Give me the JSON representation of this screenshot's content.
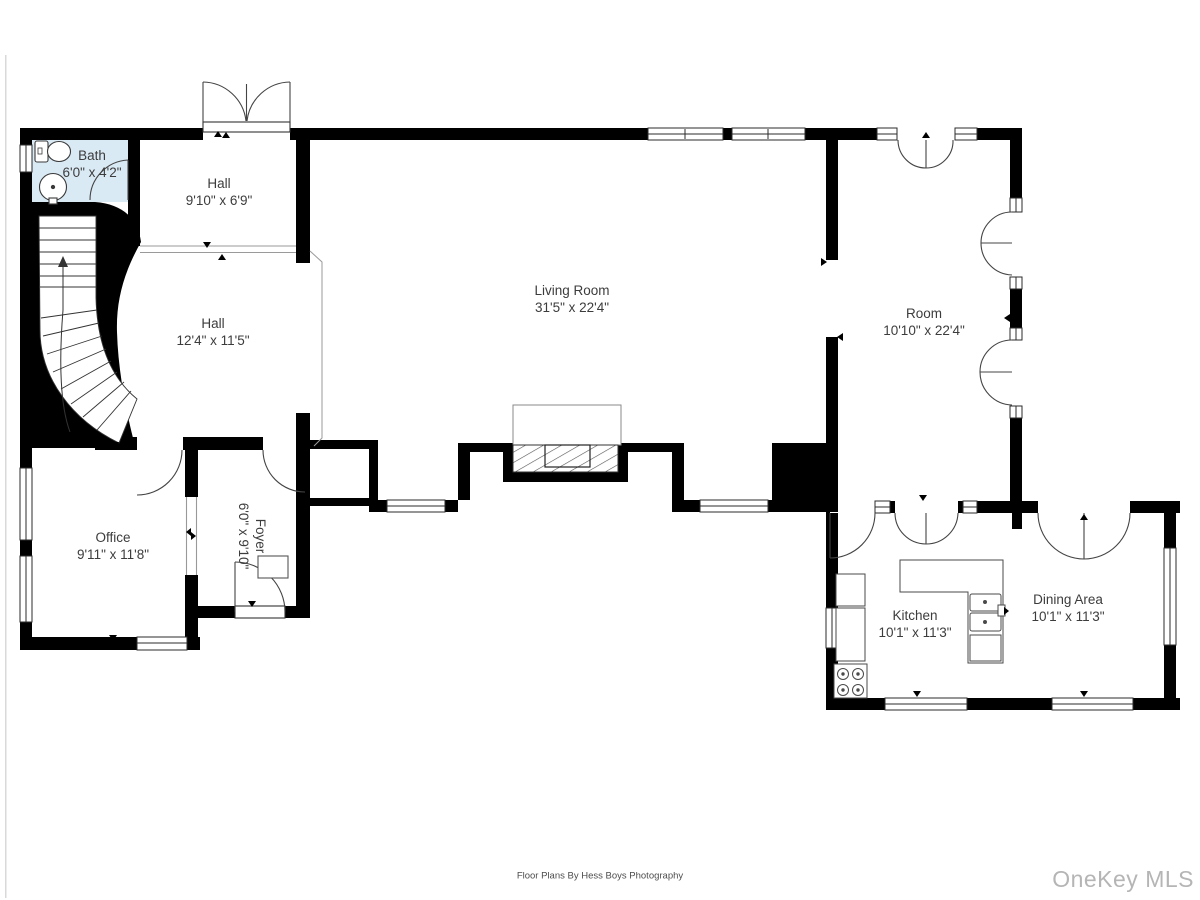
{
  "floor_plan": {
    "rooms": [
      {
        "id": "bath",
        "name": "Bath",
        "dimensions": "6'0\" x 4'2\"",
        "label_x": 92,
        "label_y": 164,
        "rotated": false
      },
      {
        "id": "hall-upper",
        "name": "Hall",
        "dimensions": "9'10\" x 6'9\"",
        "label_x": 219,
        "label_y": 192,
        "rotated": false
      },
      {
        "id": "hall-lower",
        "name": "Hall",
        "dimensions": "12'4\" x 11'5\"",
        "label_x": 213,
        "label_y": 332,
        "rotated": false
      },
      {
        "id": "living-room",
        "name": "Living Room",
        "dimensions": "31'5\" x 22'4\"",
        "label_x": 572,
        "label_y": 299,
        "rotated": false
      },
      {
        "id": "room",
        "name": "Room",
        "dimensions": "10'10\" x 22'4\"",
        "label_x": 924,
        "label_y": 322,
        "rotated": false
      },
      {
        "id": "office",
        "name": "Office",
        "dimensions": "9'11\" x 11'8\"",
        "label_x": 113,
        "label_y": 546,
        "rotated": false
      },
      {
        "id": "foyer",
        "name": "Foyer",
        "dimensions": "6'0\" x 9'10\"",
        "label_x": 252,
        "label_y": 536,
        "rotated": true
      },
      {
        "id": "kitchen",
        "name": "Kitchen",
        "dimensions": "10'1\" x 11'3\"",
        "label_x": 915,
        "label_y": 624,
        "rotated": false
      },
      {
        "id": "dining-area",
        "name": "Dining Area",
        "dimensions": "10'1\" x 11'3\"",
        "label_x": 1068,
        "label_y": 608,
        "rotated": false
      }
    ],
    "fixtures": [
      "toilet-icon",
      "sink-icon",
      "curved-staircase",
      "fireplace",
      "stove-icon",
      "kitchen-sink-icon",
      "counter",
      "refrigerator-icon"
    ],
    "colors": {
      "wall": "#000000",
      "bath_fill": "#daeaf5",
      "label_text": "#3c3c3c",
      "door_line": "#444444",
      "watermark": "#b5b5b5"
    }
  },
  "footer": {
    "credit": "Floor Plans By Hess Boys Photography"
  },
  "watermark": {
    "text": "OneKey MLS"
  }
}
